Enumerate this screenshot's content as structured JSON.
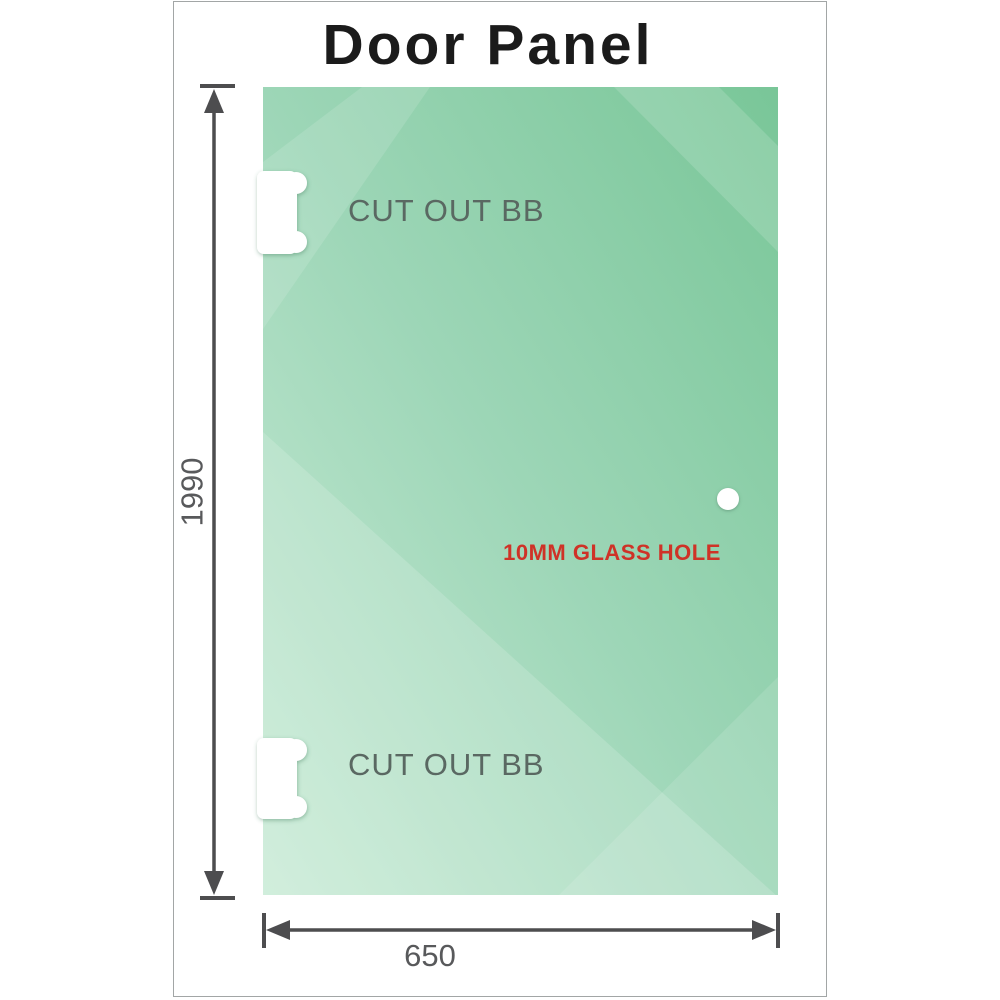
{
  "title": "Door Panel",
  "glass_panel": {
    "cutouts": [
      {
        "label": "CUT OUT BB"
      },
      {
        "label": "CUT OUT BB"
      }
    ],
    "hole": {
      "label": "10MM GLASS HOLE"
    }
  },
  "dimensions": {
    "height": "1990",
    "width": "650"
  },
  "colors": {
    "glass_dark": "#79c698",
    "glass_mid": "#9dd6b7",
    "glass_light": "#c9ebd6",
    "dimension_lines": "#4d4d4f",
    "dimension_text": "#58595b",
    "cutout_label": "#5a6862",
    "hole_label": "#cf3227",
    "title_text": "#1b1b1b",
    "canvas_border": "#a2a6a6"
  }
}
